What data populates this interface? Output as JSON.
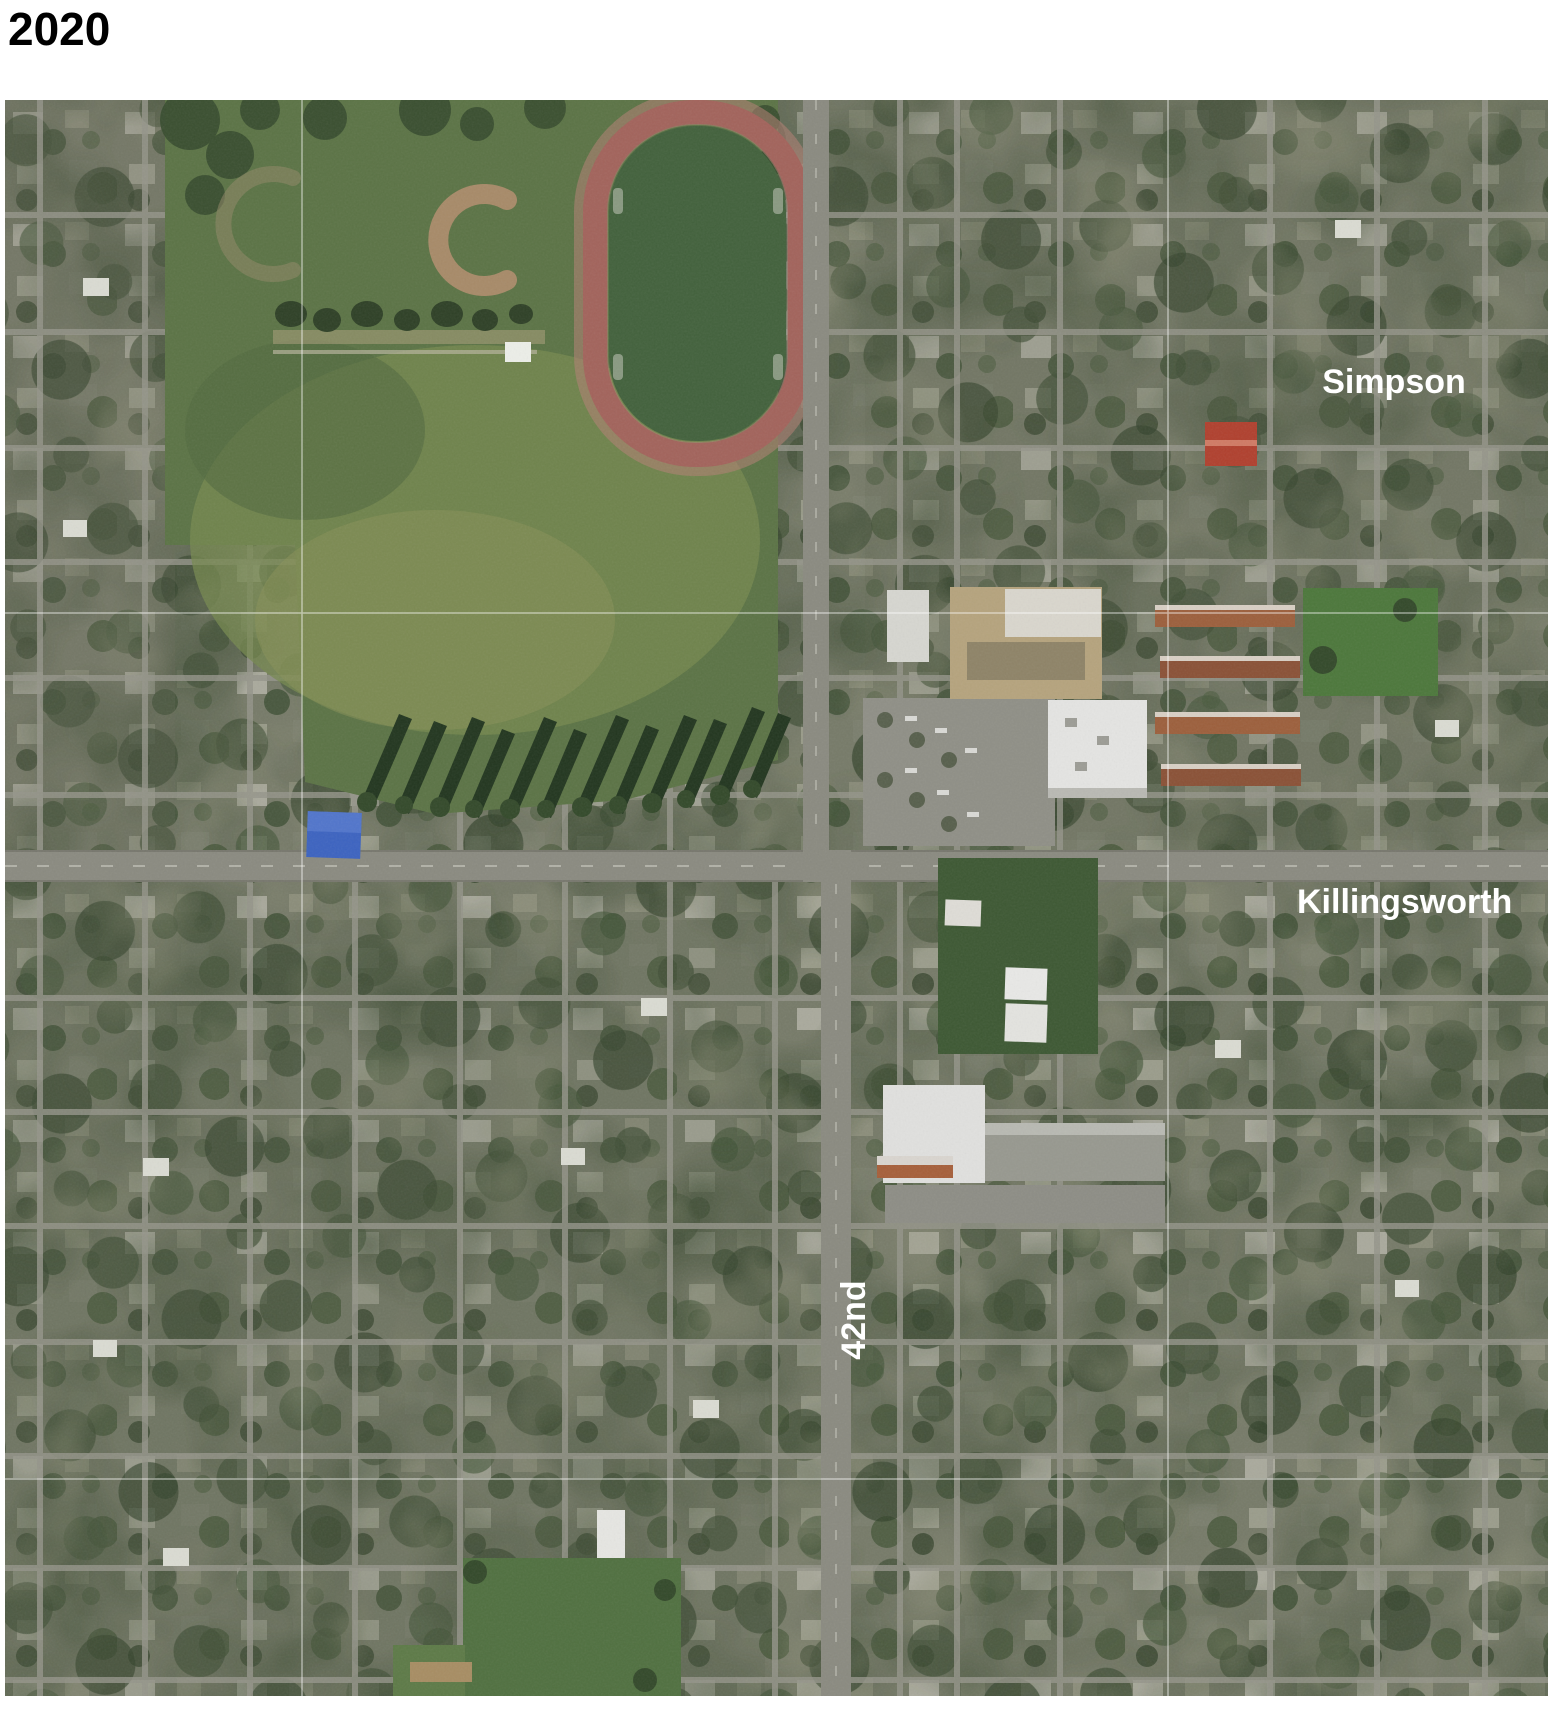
{
  "title": "2020",
  "map": {
    "type": "satellite-aerial",
    "labels": {
      "simpson": "Simpson",
      "killingsworth": "Killingsworth",
      "street_42nd": "42nd"
    },
    "colors": {
      "label_text": "#ffffff",
      "park_grass": "#5b7345",
      "lawn_light": "#76884f",
      "track_surface": "#a2635b",
      "track_infield": "#42613c",
      "baseball_dirt": "#a78a68",
      "blue_tarp": "#3c63c0",
      "major_road": "#8a8a80",
      "big_store_roof": "#e4e4e2",
      "warehouse_roof": "#e0e0de",
      "apartment_roof_tan": "#b5a37d",
      "rowhouse_brown": "#9c5f3c",
      "bottom_field_green": "#507040",
      "graticule": "#ffffff"
    }
  }
}
